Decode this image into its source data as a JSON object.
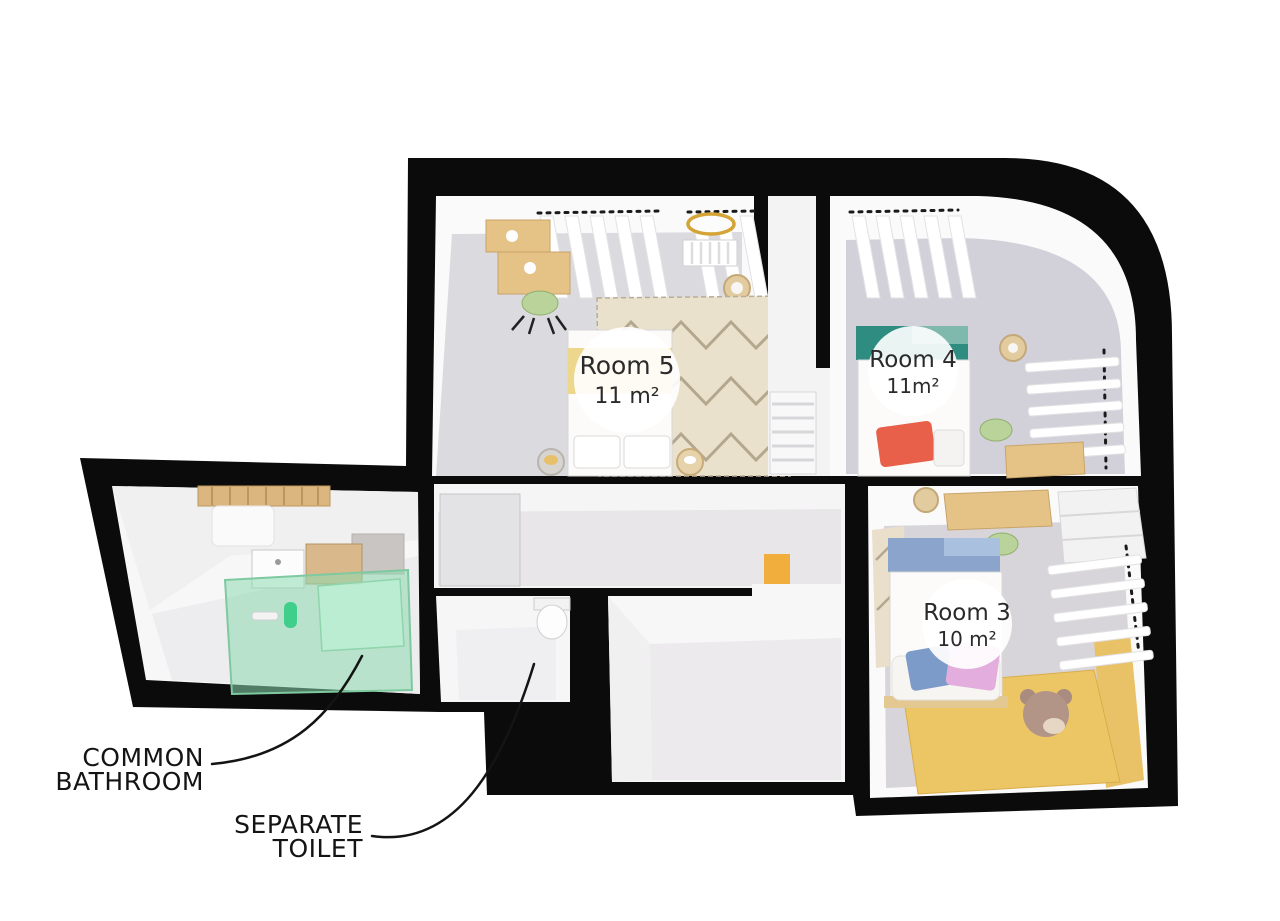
{
  "plan": {
    "rooms": [
      {
        "id": "room-5",
        "name": "Room 5",
        "area": "11 m²"
      },
      {
        "id": "room-4",
        "name": "Room 4",
        "area": "11m²"
      },
      {
        "id": "room-3",
        "name": "Room 3",
        "area": "10 m²"
      }
    ],
    "annotations": {
      "bathroom": {
        "line1": "COMMON",
        "line2": "BATHROOM"
      },
      "toilet": {
        "line1": "SEPARATE",
        "line2": "TOILET"
      }
    },
    "colors": {
      "wall": "#0b0b0b",
      "room_floor": "#dbdade",
      "corridor_floor": "#e8e6e8",
      "teal_headboard": "#2f8c80",
      "teal_light": "#7fb9ad",
      "mint_bath": "#8ddbb0",
      "soap_green": "#3fcf8a",
      "yellow_band": "#ecd78d",
      "yellow_floor": "#ecc564",
      "yellow_wall": "#e9c268",
      "orange_accent": "#f2ae3d",
      "blue_headboard": "#8aa4cc",
      "blue_light": "#a9c0de",
      "blue_pillow": "#7d9bc8",
      "red_pillow": "#e8604a",
      "pink_pillow": "#e3aede",
      "wood": "#e5c386",
      "wood_dark": "#c9a369",
      "gold": "#d4a437",
      "label_text": "#141414"
    }
  }
}
